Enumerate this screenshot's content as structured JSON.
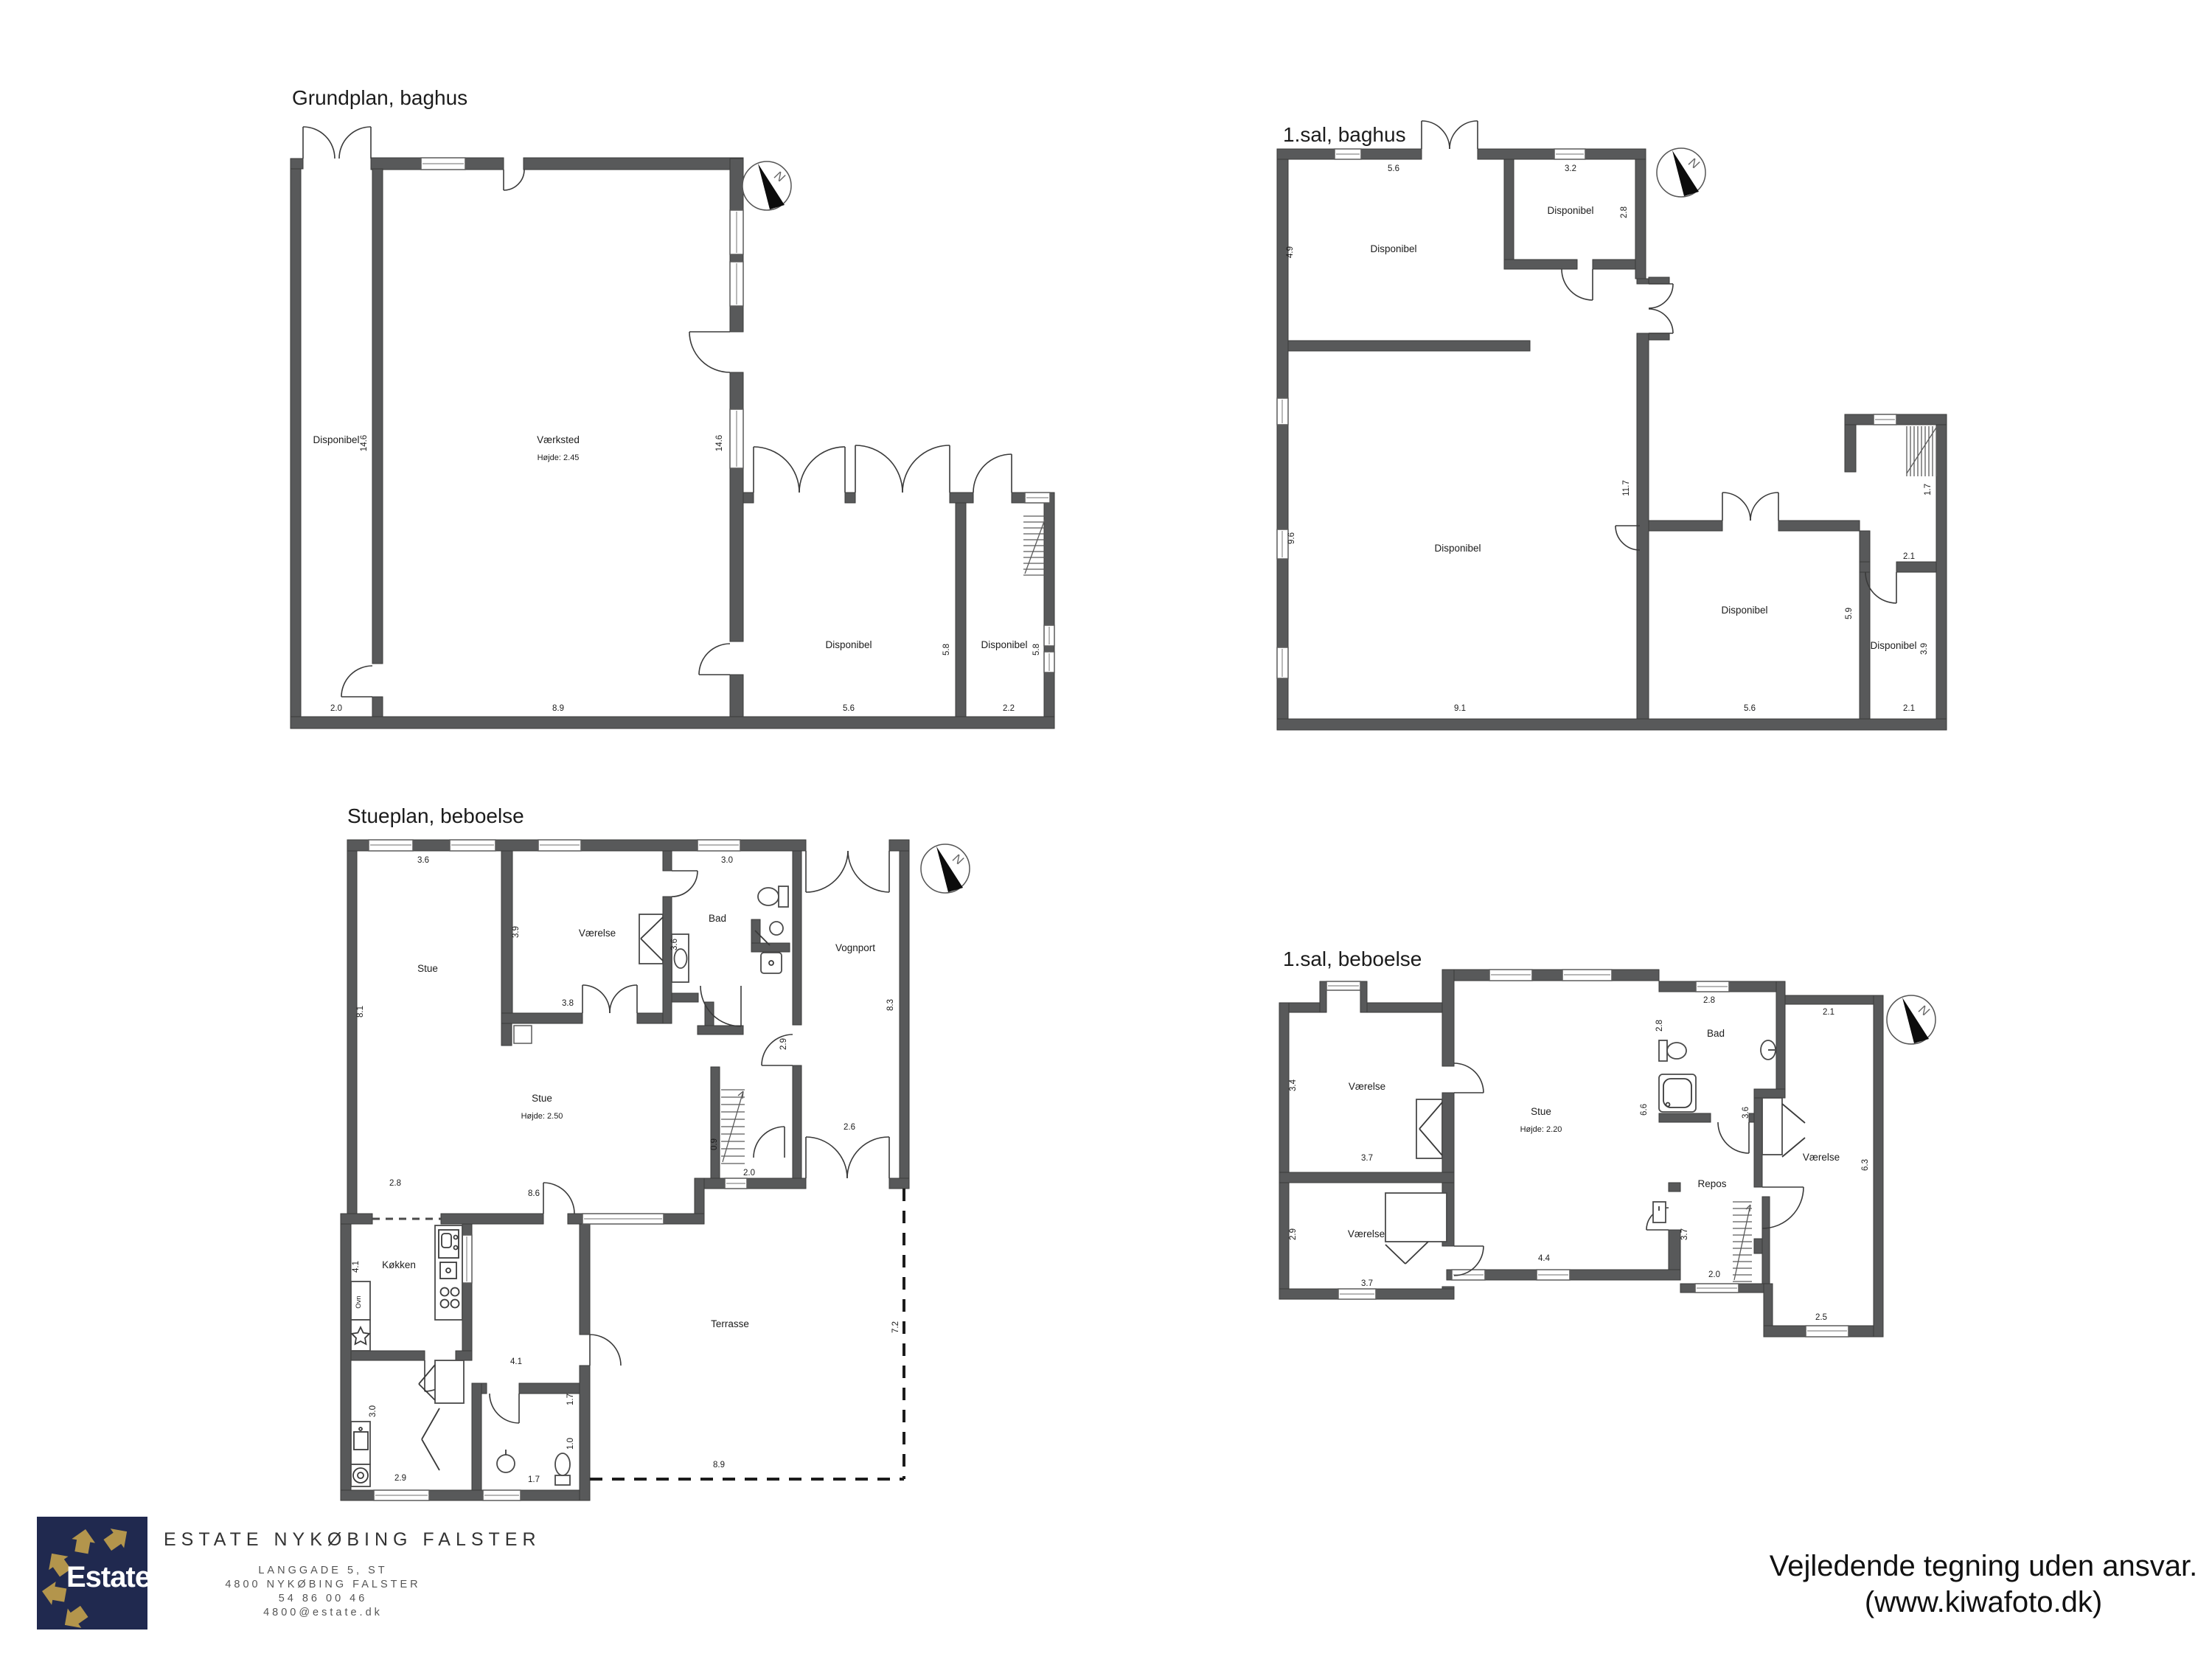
{
  "colors": {
    "wall": "#58595a",
    "line": "#3a3a3a",
    "navy": "#20294f",
    "gold": "#b3954c"
  },
  "compass_n": "N",
  "plan1": {
    "title": "Grundplan, baghus",
    "room_strip": "Disponibel",
    "dim_strip_h": "14.6",
    "dim_strip_w": "2.0",
    "room_workshop": "Værksted",
    "workshop_height": "Højde: 2.45",
    "dim_workshop_h": "14.6",
    "dim_workshop_w": "8.9",
    "room_garage": "Disponibel",
    "dim_garage_h": "5.8",
    "dim_garage_w": "5.6",
    "room_stairs": "Disponibel",
    "dim_stairs_h": "5.8",
    "dim_stairs_w": "2.2"
  },
  "plan2": {
    "title": "1.sal, baghus",
    "dim_top_w": "5.6",
    "dim_ne_w": "3.2",
    "room_ne": "Disponibel",
    "dim_ne_h": "2.8",
    "room_nw": "Disponibel",
    "dim_nw_h": "4.9",
    "room_sw": "Disponibel",
    "dim_sw_h": "9.6",
    "dim_mid_h": "11.7",
    "room_se": "Disponibel",
    "dim_se_h": "5.9",
    "dim_stair_w": "2.1",
    "dim_stair_h": "1.7",
    "room_far": "Disponibel",
    "dim_far_h": "3.9",
    "dim_sw_w": "9.1",
    "dim_se_w": "5.6",
    "dim_far_w": "2.1"
  },
  "plan3": {
    "title": "Stueplan, beboelse",
    "dim_stue_top": "3.6",
    "dim_bad_top": "3.0",
    "dim_left": "8.1",
    "room_stue_nw": "Stue",
    "room_vaerelse": "Værelse",
    "dim_vaerelse_l": "3.9",
    "dim_vaerelse_b": "3.8",
    "room_bad": "Bad",
    "dim_bad_l": "3.6",
    "room_vognport": "Vognport",
    "dim_vognport_r": "8.3",
    "dim_vognport_b": "2.6",
    "dim_hall": "2.9",
    "dim_stair_b": "2.0",
    "dim_stair_l": "0.9",
    "room_stue": "Stue",
    "stue_height": "Højde: 2.50",
    "dim_stue_b": "8.6",
    "dim_koekken_top": "2.8",
    "room_koekken": "Køkken",
    "dim_koekken_l": "4.1",
    "label_ovn": "Ovn",
    "dim_hall_b": "4.1",
    "dim_laundry_l": "3.0",
    "dim_laundry_b": "2.9",
    "dim_bath_b": "1.7",
    "dim_bath_r": "1.0",
    "dim_corr_r": "1.7",
    "room_terrasse": "Terrasse",
    "dim_terrasse_b": "8.9",
    "dim_terrasse_r": "7.2"
  },
  "plan4": {
    "title": "1.sal, beboelse",
    "room_v1": "Værelse",
    "dim_v1_l": "3.4",
    "dim_v1_b": "3.7",
    "room_v2": "Værelse",
    "dim_v2_l": "2.9",
    "dim_v2_b": "3.7",
    "room_stue": "Stue",
    "stue_height": "Højde: 2.20",
    "dim_stue_b": "4.4",
    "dim_stue_r": "6.6",
    "room_bad": "Bad",
    "dim_bad_top": "2.8",
    "dim_bad_l": "2.8",
    "dim_mid": "3.6",
    "room_repos": "Repos",
    "dim_repos_r": "3.7",
    "dim_repos_b": "2.0",
    "room_v3": "Værelse",
    "dim_v3_top": "2.1",
    "dim_v3_r": "6.3",
    "dim_v3_b": "2.5"
  },
  "logo": {
    "brand": "Estate",
    "reg": "®",
    "agency_name": "ESTATE NYKØBING FALSTER",
    "address1": "LANGGADE 5, ST",
    "address2": "4800 NYKØBING FALSTER",
    "phone": "54 86 00 46",
    "email": "4800@estate.dk"
  },
  "footer": {
    "line1": "Vejledende tegning uden ansvar.",
    "line2": "(www.kiwafoto.dk)"
  }
}
